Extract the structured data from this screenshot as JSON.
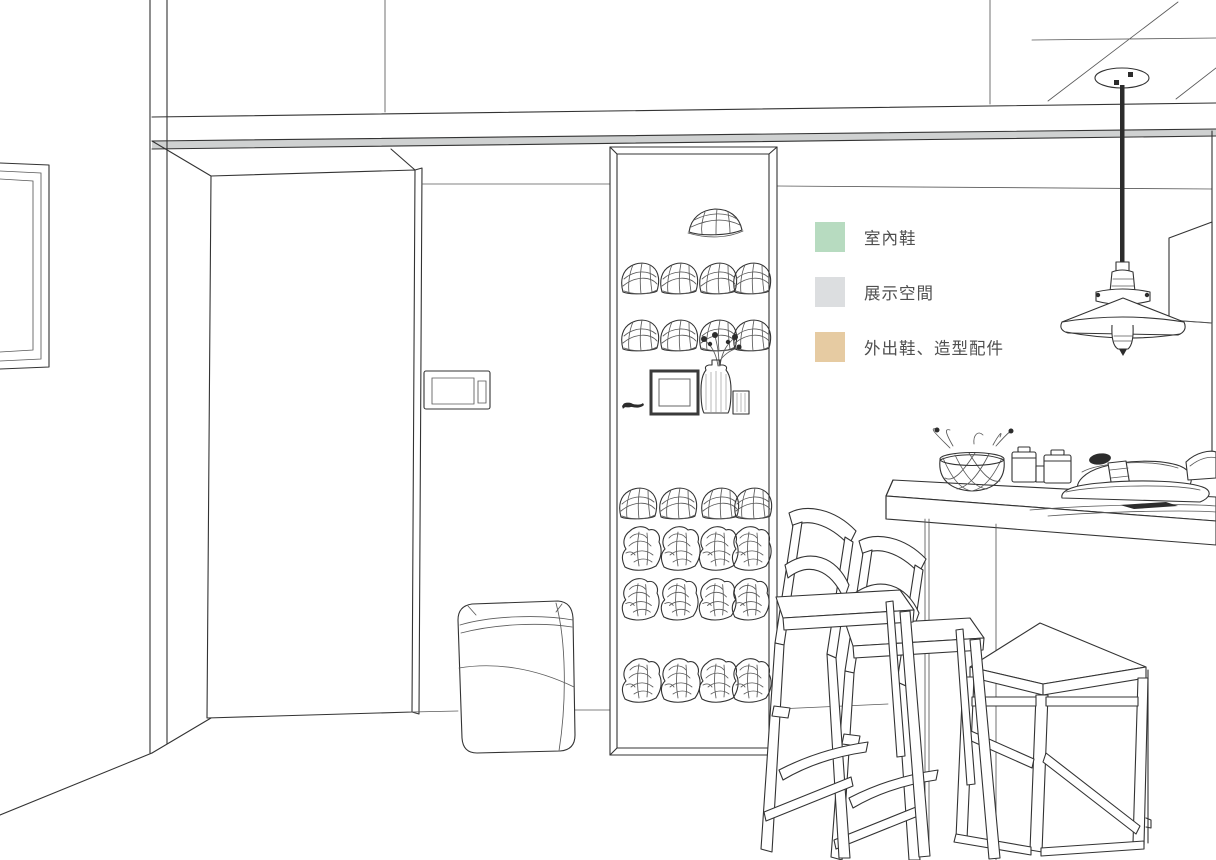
{
  "legend": {
    "items": [
      {
        "id": "indoor-shoes",
        "label": "室內鞋",
        "color": "#b7dbc0"
      },
      {
        "id": "display-space",
        "label": "展示空間",
        "color": "#dcdee0"
      },
      {
        "id": "outdoor-shoes-accessories",
        "label": "外出鞋、造型配件",
        "color": "#e6cba2"
      }
    ]
  },
  "palette": {
    "display": "#e8eaec",
    "display_side": "#d6d9da",
    "display_shelf": "#d2d5d6",
    "indoor": "#dff0e2",
    "indoor_side": "#cbe6d2",
    "indoor_shelf": "#d5e8da",
    "outdoor": "#f6e9d4",
    "outdoor_side": "#ecd5af",
    "outdoor_shelf": "#e8d0a8",
    "beam_shadow": "#cfd1d1",
    "cabinet_base": "#f6f7f7"
  }
}
